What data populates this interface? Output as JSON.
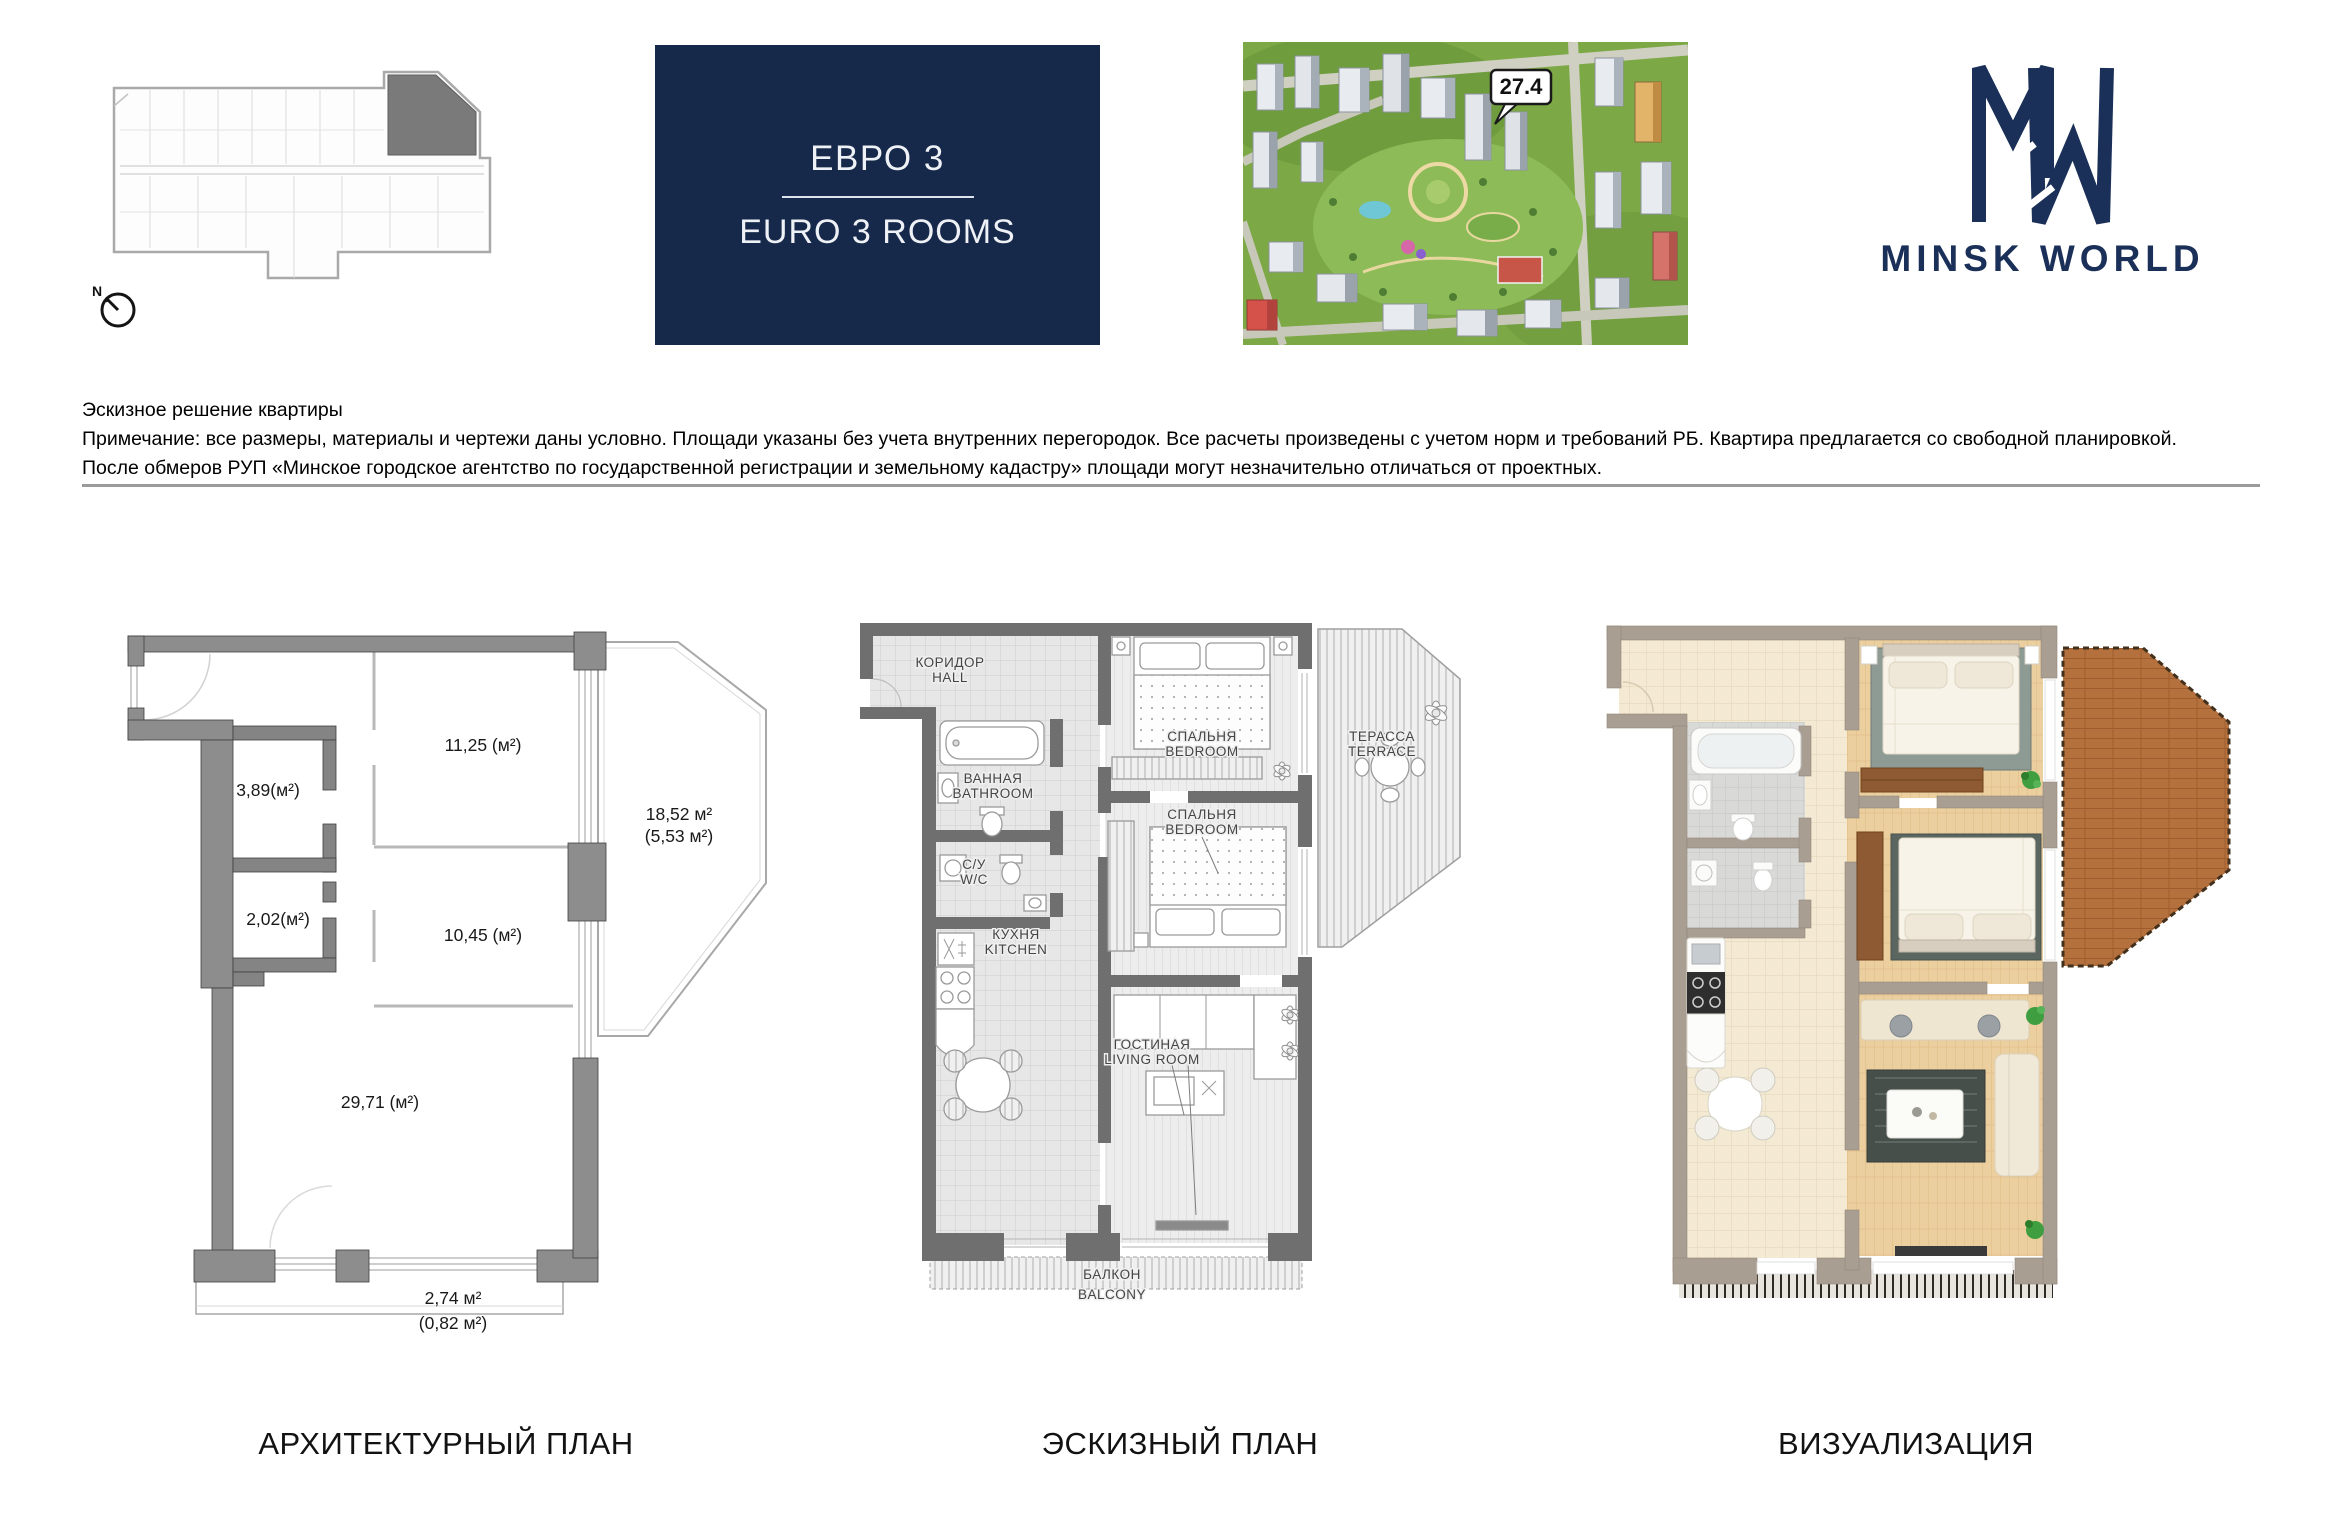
{
  "header": {
    "unit_type_ru": "ЕВРО 3",
    "unit_type_en": "EURO 3 ROOMS",
    "building_callout": "27.4",
    "compass_label": "N",
    "logo_text": "MINSK WORLD",
    "panel_color": "#17294a",
    "logo_color": "#1b3058"
  },
  "disclaimer": {
    "line1": "Эскизное решение квартиры",
    "line2": "Примечание: все размеры, материалы и чертежи даны условно. Площади указаны без учета внутренних перегородок. Все расчеты произведены с учетом норм и требований РБ. Квартира предлагается со свободной планировкой.",
    "line3": "После обмеров РУП «Минское городское агентство по государственной регистрации и земельному кадастру» площади могут незначительно отличаться от проектных."
  },
  "plans": {
    "architectural": {
      "caption": "АРХИТЕКТУРНЫЙ ПЛАН",
      "areas": {
        "storage_a": "3,89(м²)",
        "storage_b": "2,02(м²)",
        "room_a": "11,25 (м²)",
        "room_b": "10,45 (м²)",
        "terrace": "18,52 м²",
        "terrace_reduced": "(5,53 м²)",
        "living": "29,71 (м²)",
        "balcony": "2,74 м²",
        "balcony_reduced": "(0,82 м²)"
      }
    },
    "sketch": {
      "caption": "ЭСКИЗНЫЙ ПЛАН",
      "rooms": {
        "hall": {
          "ru": "КОРИДОР",
          "en": "HALL"
        },
        "bathroom": {
          "ru": "ВАННАЯ",
          "en": "BATHROOM"
        },
        "wc": {
          "ru": "С/У",
          "en": "W/C"
        },
        "kitchen": {
          "ru": "КУХНЯ",
          "en": "KITCHEN"
        },
        "bedroom1": {
          "ru": "СПАЛЬНЯ",
          "en": "BEDROOM"
        },
        "bedroom2": {
          "ru": "СПАЛЬНЯ",
          "en": "BEDROOM"
        },
        "terrace": {
          "ru": "ТЕРАССА",
          "en": "TERRACE"
        },
        "living": {
          "ru": "ГОСТИНАЯ",
          "en": "LIVING ROOM"
        },
        "balcony": {
          "ru": "БАЛКОН",
          "en": "BALCONY"
        }
      }
    },
    "visualization": {
      "caption": "ВИЗУАЛИЗАЦИЯ"
    }
  }
}
